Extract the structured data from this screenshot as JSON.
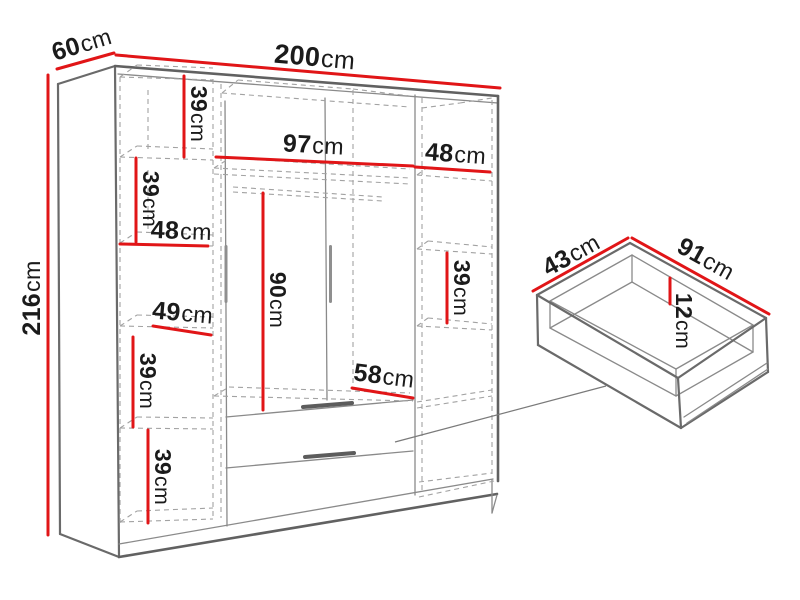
{
  "diagram": {
    "unit": "cm",
    "colors": {
      "dimension_red": "#e11517",
      "outline_gray": "#6a6a6a",
      "dashed_gray": "#a2a2a2",
      "text": "#1b1b1b",
      "background": "#ffffff"
    },
    "wardrobe": {
      "overall": {
        "width": {
          "value": "200",
          "unit": "cm"
        },
        "depth": {
          "value": "60",
          "unit": "cm"
        },
        "height": {
          "value": "216",
          "unit": "cm"
        }
      },
      "interior": {
        "left_shelf_1": {
          "value": "39",
          "unit": "cm"
        },
        "left_shelf_2": {
          "value": "39",
          "unit": "cm"
        },
        "left_width": {
          "value": "48",
          "unit": "cm"
        },
        "left_shelf_width": {
          "value": "49",
          "unit": "cm"
        },
        "left_shelf_3": {
          "value": "39",
          "unit": "cm"
        },
        "left_shelf_4": {
          "value": "39",
          "unit": "cm"
        },
        "middle_width": {
          "value": "97",
          "unit": "cm"
        },
        "right_width": {
          "value": "48",
          "unit": "cm"
        },
        "right_shelf": {
          "value": "39",
          "unit": "cm"
        },
        "hanging_height": {
          "value": "90",
          "unit": "cm"
        },
        "bottom_width": {
          "value": "58",
          "unit": "cm"
        }
      }
    },
    "drawer": {
      "depth": {
        "value": "43",
        "unit": "cm"
      },
      "width": {
        "value": "91",
        "unit": "cm"
      },
      "height": {
        "value": "12",
        "unit": "cm"
      }
    }
  }
}
